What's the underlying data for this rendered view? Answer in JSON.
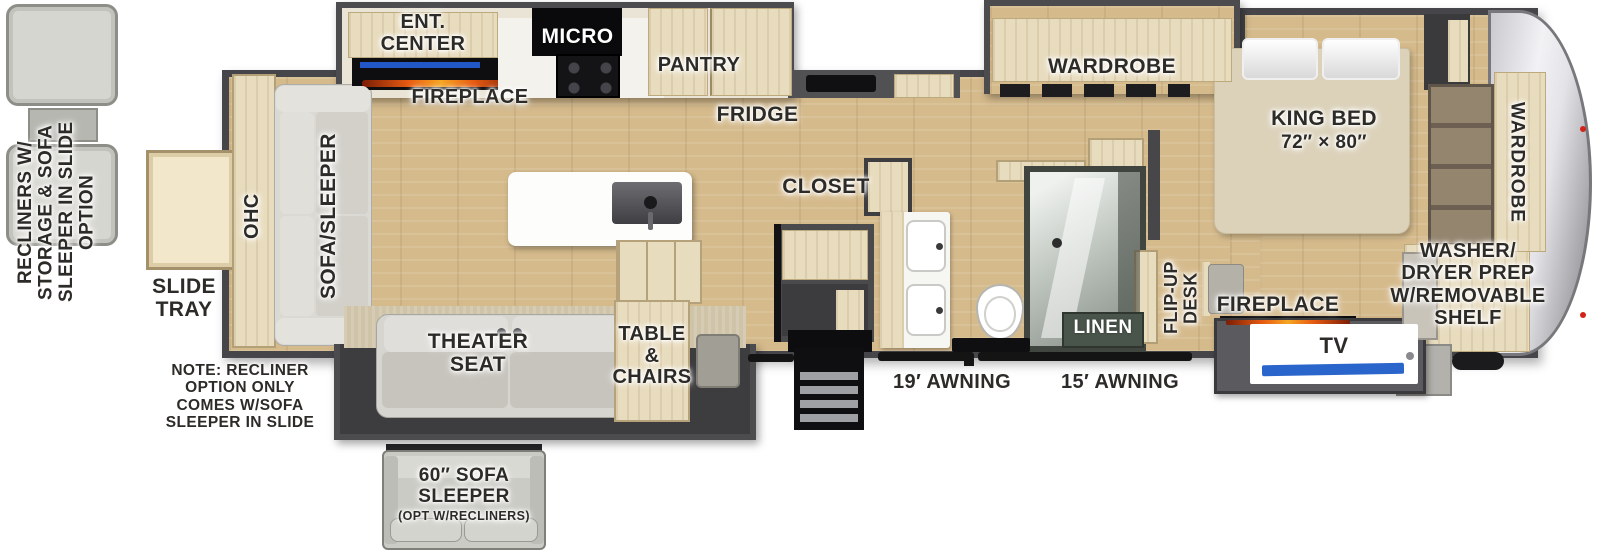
{
  "options": {
    "recliners": "RECLINERS W/\nSTORAGE & SOFA\nSLEEPER IN SLIDE\nOPTION",
    "note": "NOTE: RECLINER\nOPTION ONLY\nCOMES W/SOFA\nSLEEPER IN SLIDE",
    "sofa60_title": "60″ SOFA\nSLEEPER",
    "sofa60_sub": "(OPT W/RECLINERS)"
  },
  "exterior": {
    "slide_tray": "SLIDE\nTRAY",
    "awning19": "19′ AWNING",
    "awning15": "15′ AWNING"
  },
  "living": {
    "ohc": "OHC",
    "sofa_sleeper": "SOFA/SLEEPER",
    "theater_seat": "THEATER\nSEAT",
    "table_chairs": "TABLE\n&\nCHAIRS"
  },
  "kitchen": {
    "ent_center": "ENT.\nCENTER",
    "fireplace": "FIREPLACE",
    "micro": "MICRO",
    "pantry": "PANTRY",
    "fridge": "FRIDGE",
    "closet": "CLOSET"
  },
  "bath": {
    "linen": "LINEN"
  },
  "bedroom": {
    "wardrobe": "WARDROBE",
    "king_bed": "KING BED",
    "king_bed_size": "72″ × 80″",
    "flip_up_desk": "FLIP-UP\nDESK",
    "fireplace": "FIREPLACE",
    "tv": "TV"
  },
  "front": {
    "wardrobe": "WARDROBE",
    "washer_dryer": "WASHER/\nDRYER PREP\nW/REMOVABLE\nSHELF"
  }
}
